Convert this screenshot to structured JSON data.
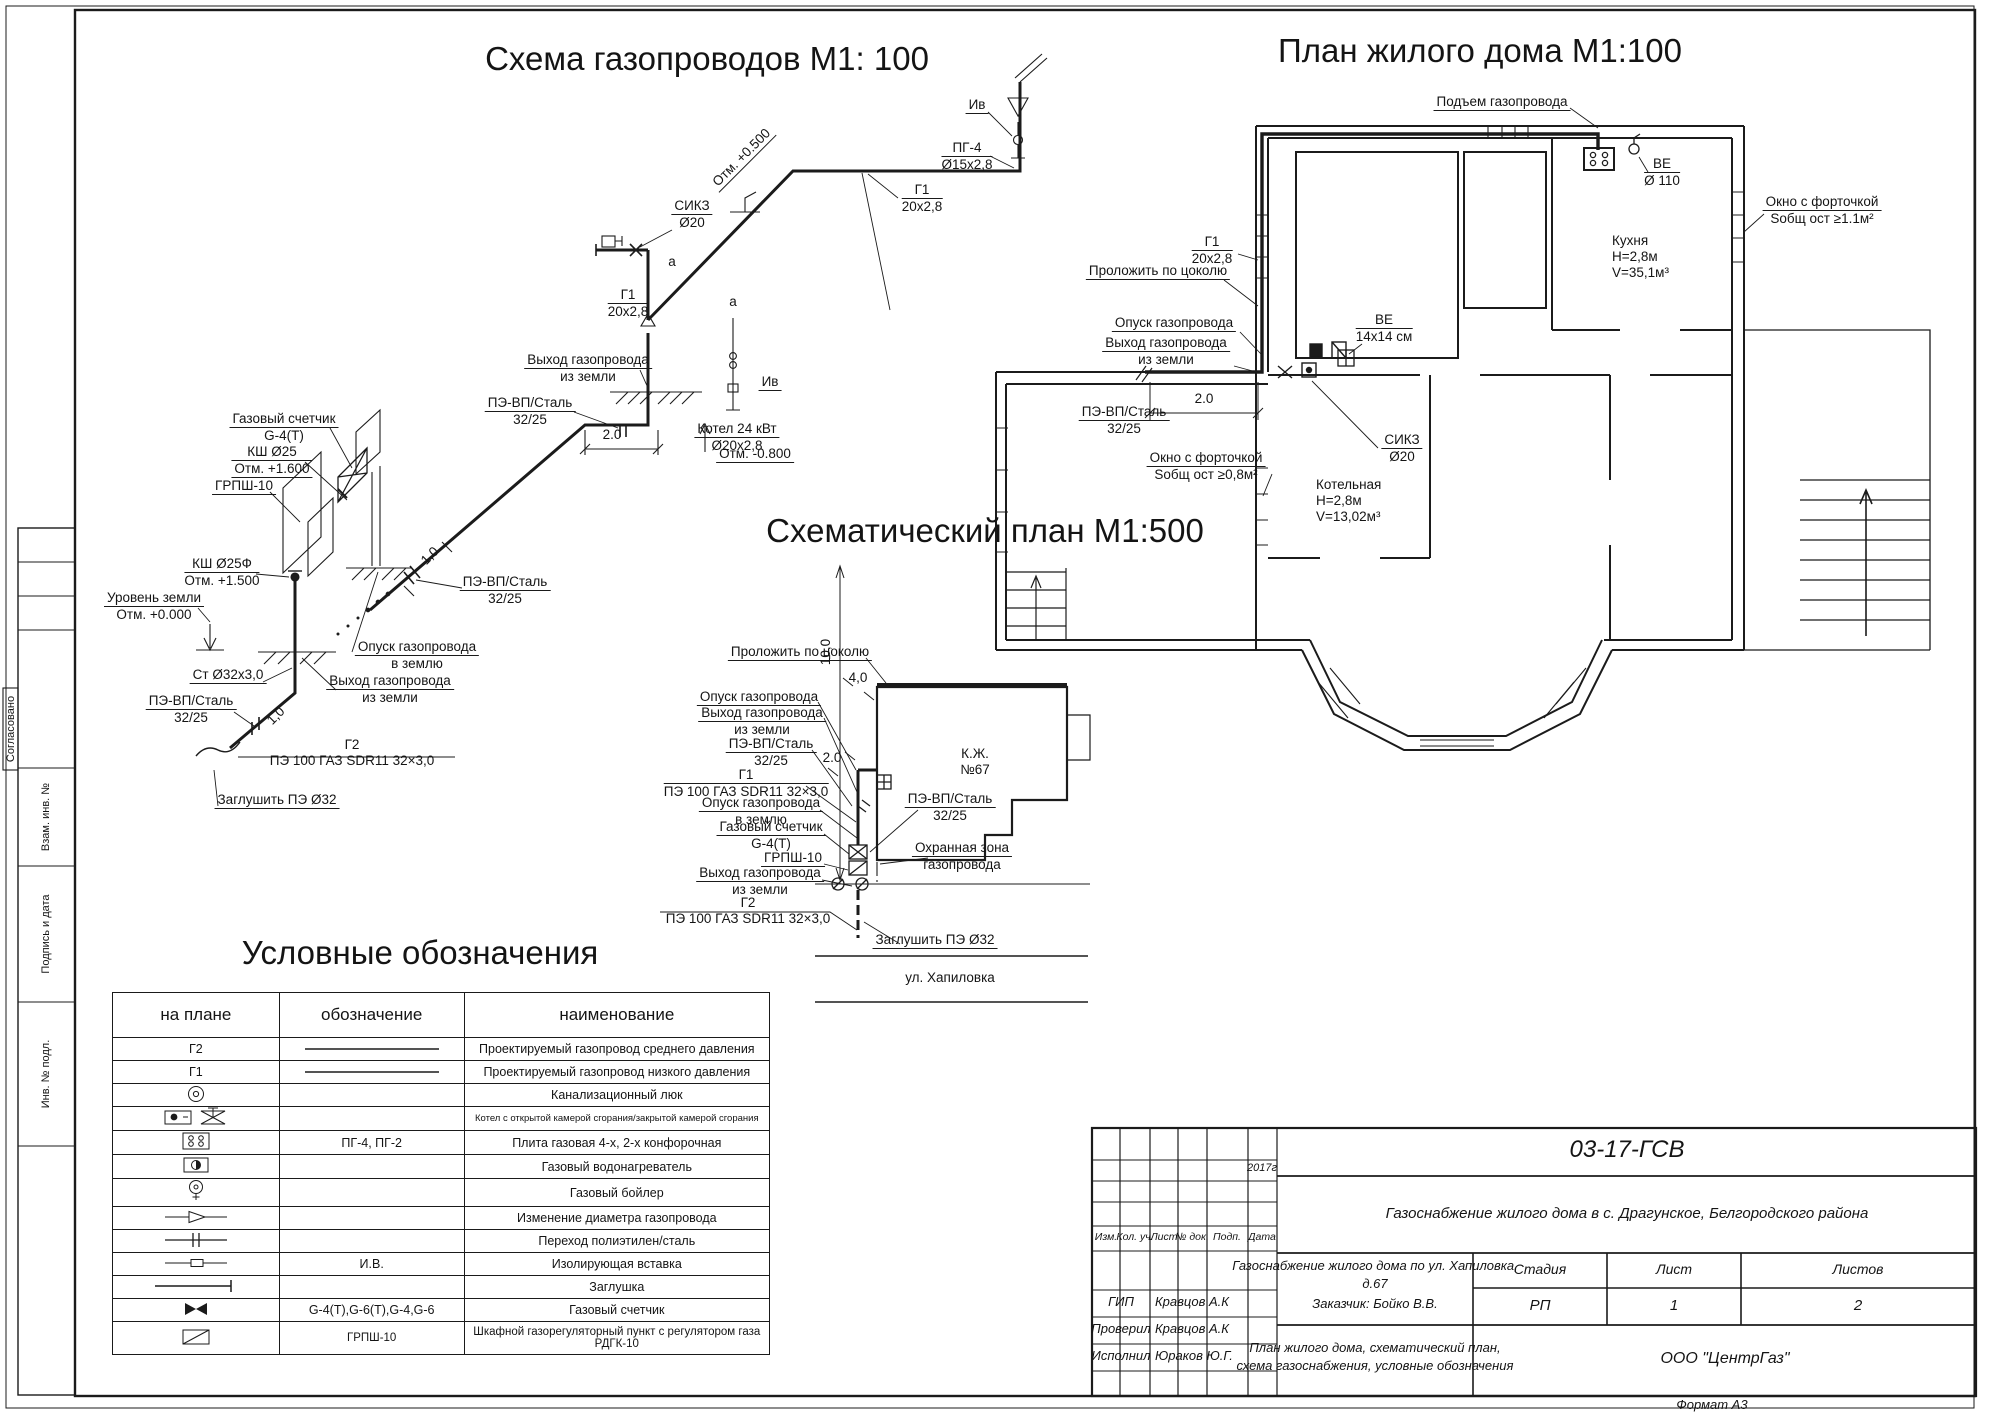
{
  "titles": {
    "scheme": "Схема газопроводов М1: 100",
    "plan": "План жилого дома М1:100",
    "schematic": "Схематический план М1:500",
    "legend": "Условные обозначения"
  },
  "scheme": {
    "s1": {
      "a": "Отм. +0.500"
    },
    "s2": {
      "a": "СИКЗ",
      "b": "Ø20"
    },
    "s3": {
      "a": "Г1",
      "b": "20х2,8"
    },
    "s4": {
      "a": "ПГ-4",
      "b": "Ø15х2,8"
    },
    "s5": {
      "a": "Ив"
    },
    "s6": {
      "a": "а"
    },
    "s6b": {
      "a": "а"
    },
    "s7": {
      "a": "Г1",
      "b": "20х2,8"
    },
    "s8": {
      "a": "Выход газопровода",
      "b": "из земли"
    },
    "s9": {
      "a": "ПЭ-ВП/Сталь",
      "b": "32/25"
    },
    "s10": {
      "a": "2.0"
    },
    "s11": {
      "a": "Отм. -0.800"
    },
    "s12": {
      "a": "Ив"
    },
    "s13": {
      "a": "Котел 24 кВт",
      "b": "Ø20х2,8"
    },
    "s14": {
      "a": "Газовый счетчик",
      "b": "G-4(Т)"
    },
    "s15": {
      "a": "КШ Ø25",
      "b": "Отм. +1.600"
    },
    "s16": {
      "a": "ГРПШ-10"
    },
    "s17": {
      "a": "КШ Ø25Ф",
      "b": "Отм. +1.500"
    },
    "s18": {
      "a": "Уровень земли",
      "b": "Отм. +0.000"
    },
    "s19": {
      "a": "Ст Ø32х3,0"
    },
    "s20": {
      "a": "ПЭ-ВП/Сталь",
      "b": "32/25"
    },
    "s21": {
      "a": "Опуск газопровода",
      "b": "в землю"
    },
    "s22": {
      "a": "Выход газопровода",
      "b": "из земли"
    },
    "s23": {
      "a": "1,0"
    },
    "s24": {
      "a": "1,0"
    },
    "s25": {
      "a": "Г2",
      "b": "ПЭ 100 ГАЗ SDR11 32×3,0"
    },
    "s26": {
      "a": "Заглушить ПЭ Ø32"
    },
    "s27": {
      "a": "ПЭ-ВП/Сталь",
      "b": "32/25"
    }
  },
  "plan": {
    "p1": {
      "a": "Подъем газопровода"
    },
    "p2": {
      "a": "ВЕ",
      "b": "Ø 110"
    },
    "p3": {
      "a": "Окно с форточкой",
      "b": "Sобщ ост ≥1.1м²"
    },
    "p4": {
      "a": "Кухня",
      "b": "Н=2,8м",
      "c": "V=35,1м³"
    },
    "p5": {
      "a": "Г1",
      "b": "20х2,8"
    },
    "p6": {
      "a": "Проложить по цоколю"
    },
    "p7": {
      "a": "ВЕ",
      "b": "14х14 см"
    },
    "p8": {
      "a": "Опуск газопровода"
    },
    "p9": {
      "a": "Выход газопровода",
      "b": "из земли"
    },
    "p10": {
      "a": "ПЭ-ВП/Сталь",
      "b": "32/25"
    },
    "p11": {
      "a": "2.0"
    },
    "p12": {
      "a": "СИКЗ",
      "b": "Ø20"
    },
    "p13": {
      "a": "Окно с форточкой",
      "b": "Sобщ ост ≥0,8м²"
    },
    "p14": {
      "a": "Котельная",
      "b": "Н=2,8м",
      "c": "V=13,02м³"
    }
  },
  "schematic": {
    "c1": {
      "a": "Проложить по цоколю"
    },
    "c2": {
      "a": "4,0"
    },
    "c3": {
      "a": "Опуск газопровода"
    },
    "c4": {
      "a": "Выход газопровода",
      "b": "из земли"
    },
    "c5": {
      "a": "ПЭ-ВП/Сталь",
      "b": "32/25"
    },
    "c6": {
      "a": "2.0"
    },
    "c7": {
      "a": "Г1",
      "b": "ПЭ 100 ГАЗ SDR11 32×3,0"
    },
    "c8": {
      "a": "Опуск газопровода",
      "b": "в землю"
    },
    "c9": {
      "a": "Газовый счетчик",
      "b": "G-4(Т)"
    },
    "c10": {
      "a": "ГРПШ-10"
    },
    "c11": {
      "a": "Выход газопровода",
      "b": "из земли"
    },
    "c12": {
      "a": "Г2",
      "b": "ПЭ 100 ГАЗ SDR11 32×3,0"
    },
    "c13": {
      "a": "К.Ж.",
      "b": "№67"
    },
    "c14": {
      "a": "ПЭ-ВП/Сталь",
      "b": "32/25"
    },
    "c15": {
      "a": "Охранная зона",
      "b": "газопровода"
    },
    "c16": {
      "a": "Заглушить ПЭ Ø32"
    },
    "c17": {
      "a": "ул. Хапиловка"
    },
    "c18": {
      "a": "10,0"
    }
  },
  "legend": {
    "h1": "на плане",
    "h2": "обозначение",
    "h3": "наименование",
    "r1": {
      "c1": "Г2",
      "c3": "Проектируемый газопровод среднего давления"
    },
    "r2": {
      "c1": "Г1",
      "c3": "Проектируемый газопровод низкого давления"
    },
    "r3": {
      "c3": "Канализационный люк"
    },
    "r4": {
      "c3": "Котел с открытой камерой сгорания/закрытой камерой сгорания"
    },
    "r5": {
      "c2": "ПГ-4, ПГ-2",
      "c3": "Плита газовая 4-х, 2-х конфорочная"
    },
    "r6": {
      "c3": "Газовый водонагреватель"
    },
    "r7": {
      "c3": "Газовый бойлер"
    },
    "r8": {
      "c3": "Изменение диаметра газопровода"
    },
    "r9": {
      "c3": "Переход полиэтилен/сталь"
    },
    "r10": {
      "c2": "И.В.",
      "c3": "Изолирующая вставка"
    },
    "r11": {
      "c3": "Заглушка"
    },
    "r12": {
      "c2": "G-4(Т),G-6(Т),G-4,G-6",
      "c3": "Газовый счетчик"
    },
    "r13": {
      "c2": "ГРПШ-10",
      "c3": "Шкафной газорегуляторный пункт с регулятором газа РДГК-10"
    }
  },
  "stamp": {
    "code": "03-17-ГСВ",
    "project": "Газоснабжение жилого дома  в с. Драгунское, Белгородского района",
    "izm": "Изм.",
    "kol": "Кол. уч.",
    "list": "Лист",
    "ndoc": "№ док.",
    "podp": "Подп.",
    "data": "Дата",
    "year": "2017г",
    "object1": "Газоснабжение жилого дома по ул. Хапиловка,",
    "object2": "д.67",
    "object3": "Заказчик: Бойко В.В.",
    "stage_h": "Стадия",
    "sheet_h": "Лист",
    "sheets_h": "Листов",
    "stage": "РП",
    "sheet": "1",
    "sheets": "2",
    "r1role": "ГИП",
    "r1name": "Кравцов А.К",
    "r2role": "Проверил",
    "r2name": "Кравцов А.К",
    "r3role": "Исполнил",
    "r3name": "Юраков Ю.Г.",
    "content1": "План жилого дома, схематический план,",
    "content2": "схема газоснабжения, условные обозначения",
    "org": "ООО \"ЦентрГаз\"",
    "format": "Формат А3"
  },
  "sidebar": {
    "agreed": "Согласовано",
    "vzam": "Взам. инв. №",
    "podp": "Подпись и дата",
    "inv": "Инв. № подл."
  }
}
